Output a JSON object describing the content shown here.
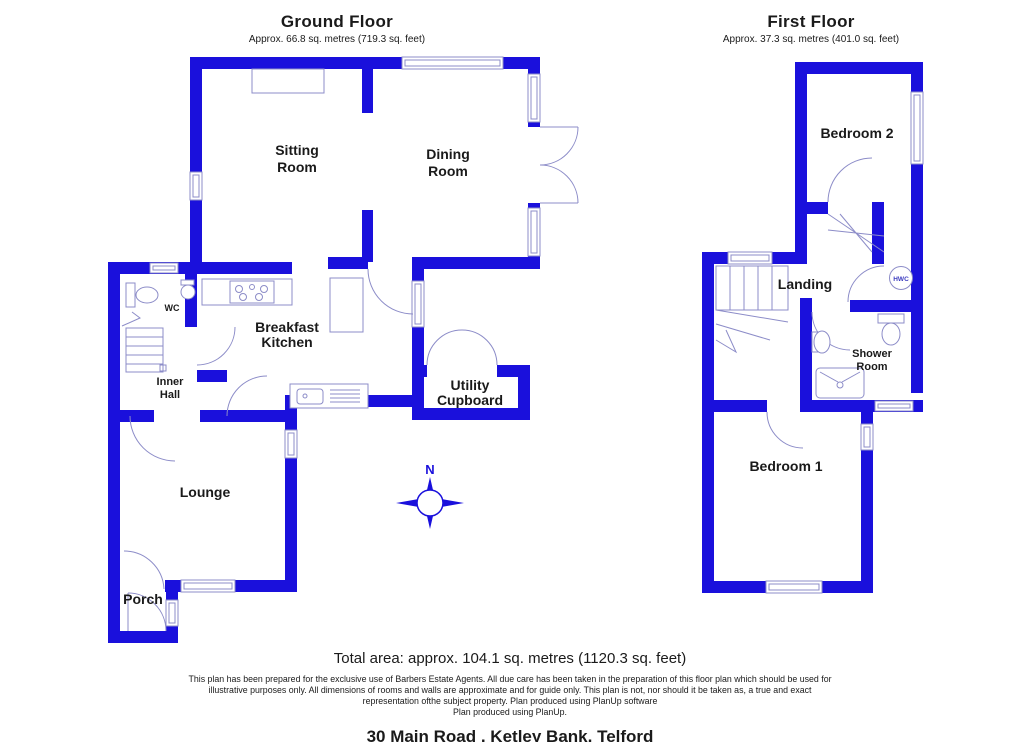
{
  "ground_floor": {
    "title": "Ground Floor",
    "subtitle": "Approx. 66.8 sq. metres (719.3 sq. feet)",
    "rooms": {
      "sitting_room": {
        "line1": "Sitting",
        "line2": "Room"
      },
      "dining_room": {
        "line1": "Dining",
        "line2": "Room"
      },
      "breakfast_kitchen": {
        "line1": "Breakfast",
        "line2": "Kitchen"
      },
      "utility_cupboard": {
        "line1": "Utility",
        "line2": "Cupboard"
      },
      "inner_hall": {
        "line1": "Inner",
        "line2": "Hall"
      },
      "wc": "WC",
      "lounge": "Lounge",
      "porch": "Porch"
    }
  },
  "first_floor": {
    "title": "First Floor",
    "subtitle": "Approx. 37.3 sq. metres (401.0 sq. feet)",
    "rooms": {
      "bedroom_2": "Bedroom 2",
      "landing": "Landing",
      "shower_room": {
        "line1": "Shower",
        "line2": "Room"
      },
      "bedroom_1": "Bedroom 1",
      "hwc": "HWC"
    }
  },
  "compass": {
    "north_label": "N"
  },
  "footer": {
    "total_area": "Total area: approx. 104.1 sq. metres (1120.3 sq. feet)",
    "disclaimer_line1": "This plan has been prepared for the exclusive use of Barbers Estate Agents. All due care has been taken in the preparation of this floor plan which should be used for",
    "disclaimer_line2": "illustrative purposes only. All dimensions of rooms and walls are approximate and for guide only. This plan is not, nor should it be taken as, a true and exact",
    "disclaimer_line3": "representation ofthe subject property. Plan produced using PlanUp software",
    "disclaimer_line4": "Plan produced using PlanUp.",
    "address": "30 Main Road , Ketley Bank, Telford"
  },
  "colors": {
    "wall_blue": "#1a10dc",
    "thin_outline": "#8c8cc8",
    "hwc_text": "#3c3cc0",
    "text": "#1a1a1a"
  }
}
